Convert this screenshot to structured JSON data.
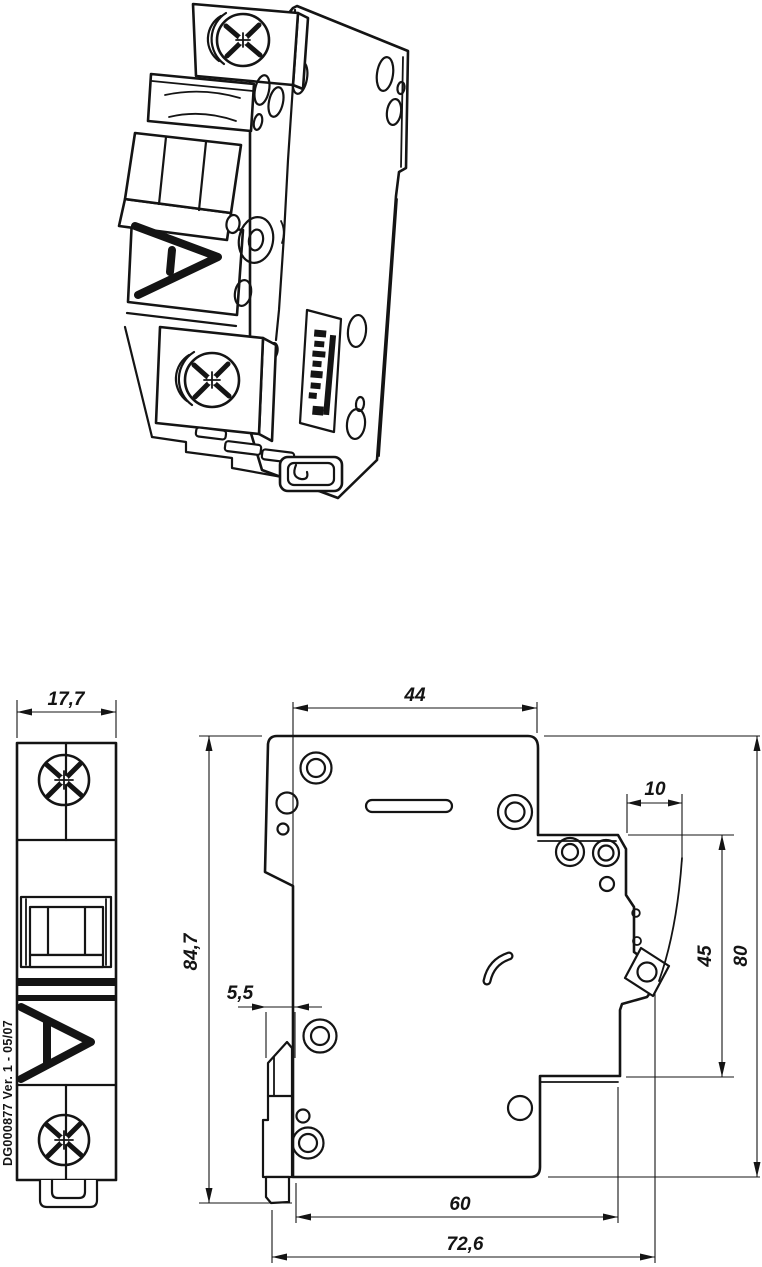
{
  "drawing": {
    "title_code": "DG000877 Ver. 1 - 05/07",
    "colors": {
      "background": "#ffffff",
      "ink": "#141414"
    },
    "views": {
      "isometric": {
        "description": "isometric projection of 1-pole circuit breaker"
      },
      "front": {
        "dimensions": {
          "width": "17,7"
        }
      },
      "side": {
        "dimensions": {
          "top_width": "44",
          "terminal_depth": "10",
          "din_offset": "5,5",
          "overall_height": "84,7",
          "recess_height": "45",
          "body_height": "80",
          "lower_width": "60",
          "overall_width": "72,6"
        }
      }
    }
  }
}
